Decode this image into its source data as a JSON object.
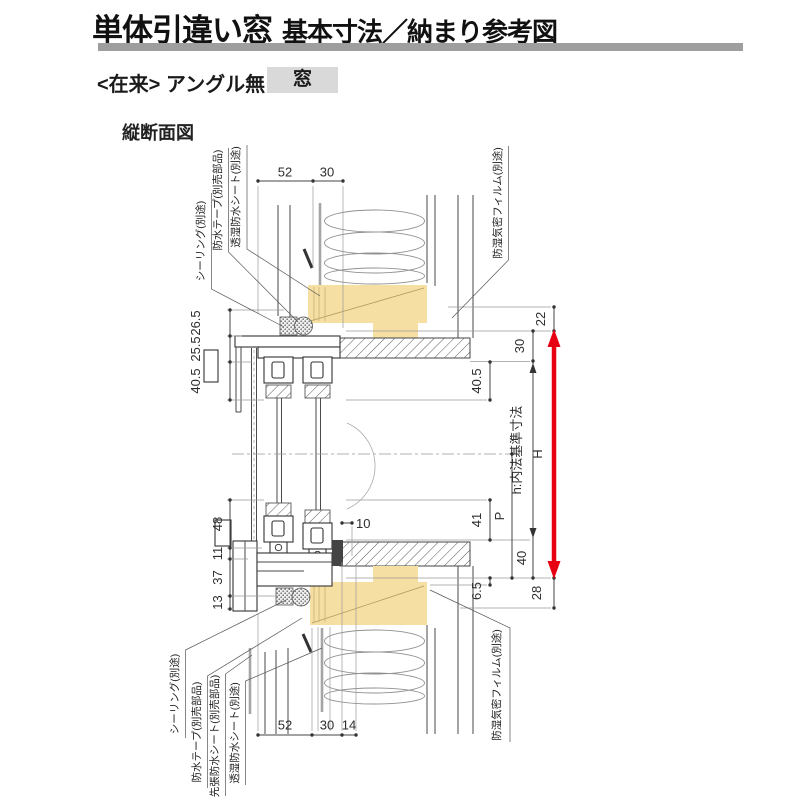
{
  "header": {
    "title_main": "単体引違い窓",
    "title_sub": "基本寸法／納まり参考図",
    "spec_prefix": "<在来> アングル無",
    "spec_tag": "窓",
    "view_label": "縦断面図"
  },
  "dimensions": {
    "top": {
      "d52": "52",
      "d30": "30"
    },
    "bottom": {
      "d52": "52",
      "d30": "30",
      "d14": "14"
    },
    "left": {
      "d26_5": "26.5",
      "d25_5": "25.5",
      "d40_5": "40.5",
      "d48": "48",
      "d11": "11",
      "d37": "37",
      "d13": "13"
    },
    "right": {
      "d22": "22",
      "d30": "30",
      "d40_5": "40.5",
      "d41": "41",
      "dP": "P",
      "d40": "40",
      "d6_5": "6.5",
      "d28": "28",
      "d10": "10",
      "height_symbol": "H",
      "inner_height": "h:内法基準寸法"
    }
  },
  "callouts": {
    "top": [
      "シーリング(別途)",
      "防水テープ(別売部品)",
      "透湿防水シート(別途)"
    ],
    "top_right": "防湿気密フィルム(別途)",
    "bottom": [
      "シーリング(別途)",
      "防水テープ(別売部品)",
      "先張防水シート(別売部品)",
      "透湿防水シート(別途)"
    ],
    "bottom_right": "防湿気密フィルム(別途)"
  },
  "colors": {
    "accent_red": "#E60012",
    "wood_fill": "#F5DFA3",
    "tag_bg": "#D9D9D9",
    "rule_bar": "#9E9E9E"
  }
}
